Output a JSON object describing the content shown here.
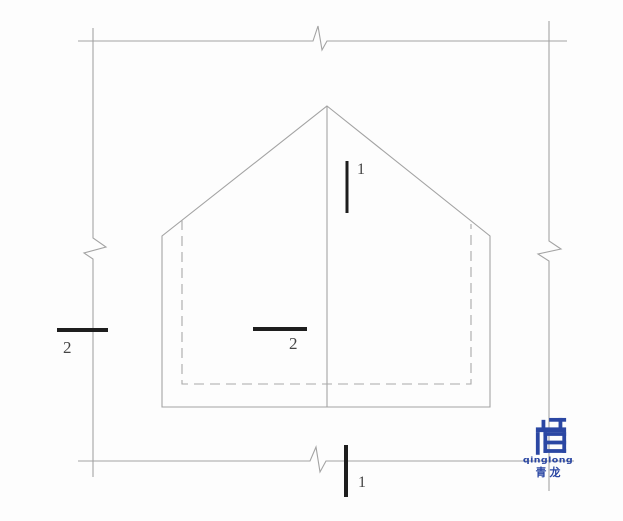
{
  "labels": {
    "section_top": "1",
    "section_bottom": "1",
    "section_left": "2",
    "section_center": "2"
  },
  "logo": {
    "latin": "qinglong",
    "chinese": "青龙"
  },
  "colors": {
    "bg": "#fdfdfd",
    "line": "#a3a3a3",
    "dash": "#a9a9a9",
    "marker": "#1e1e1e",
    "label": "#454545",
    "logo_blue": "#2b47a3"
  }
}
